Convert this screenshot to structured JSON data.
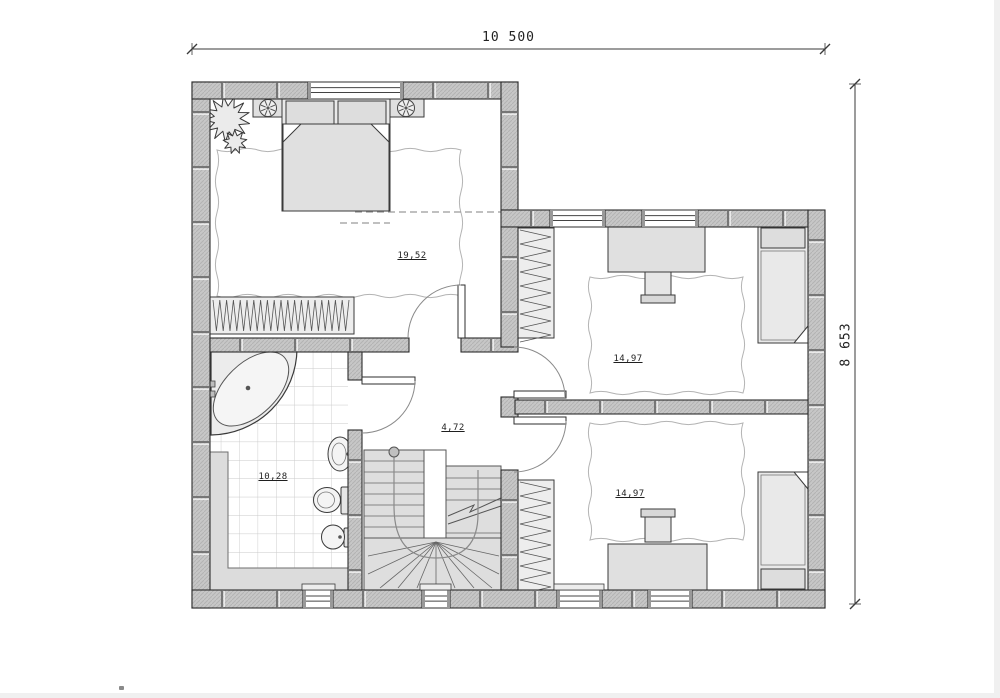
{
  "dimensions": {
    "top": "10 500",
    "right": "8 653"
  },
  "rooms": {
    "master_bedroom": {
      "area": "19,52"
    },
    "bedroom_top_right": {
      "area": "14,97"
    },
    "bedroom_bottom_right": {
      "area": "14,97"
    },
    "hall": {
      "area": "4,72"
    },
    "bathroom": {
      "area": "10,28"
    }
  }
}
